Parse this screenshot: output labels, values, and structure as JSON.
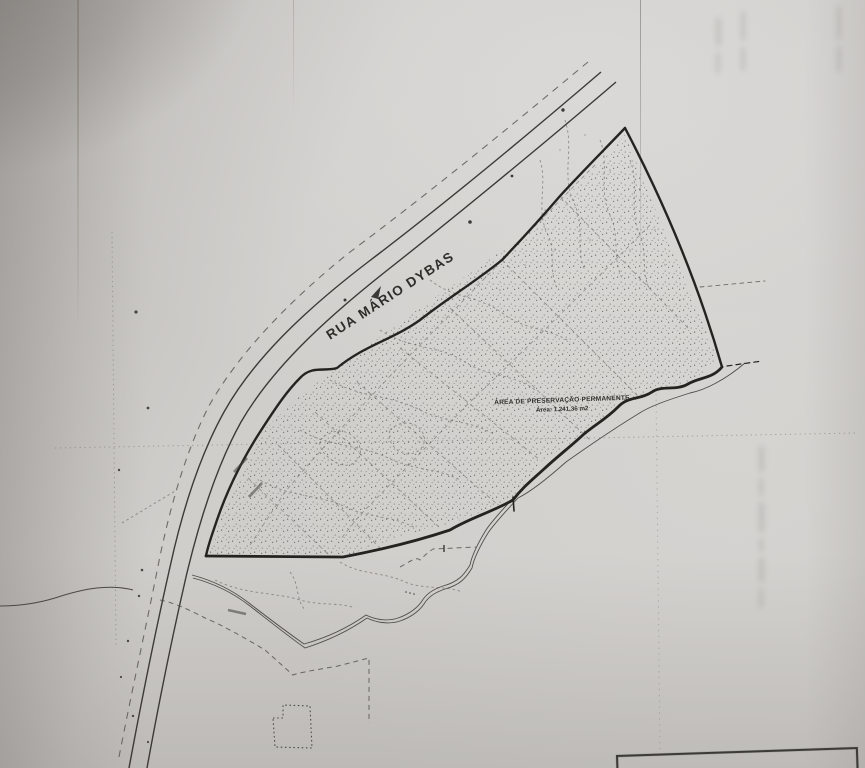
{
  "map": {
    "street_label": "RUA MÁRIO DYBAS",
    "app_area": {
      "title": "ÁREA DE PRESERVAÇÃO PERMANENTE",
      "area_value": "Área: 1.241,36 m2"
    },
    "colors": {
      "paper": "#d2d0cd",
      "ink_dark": "#2b2a26",
      "ink_medium": "#4a4844",
      "ink_light": "#75736f"
    }
  }
}
